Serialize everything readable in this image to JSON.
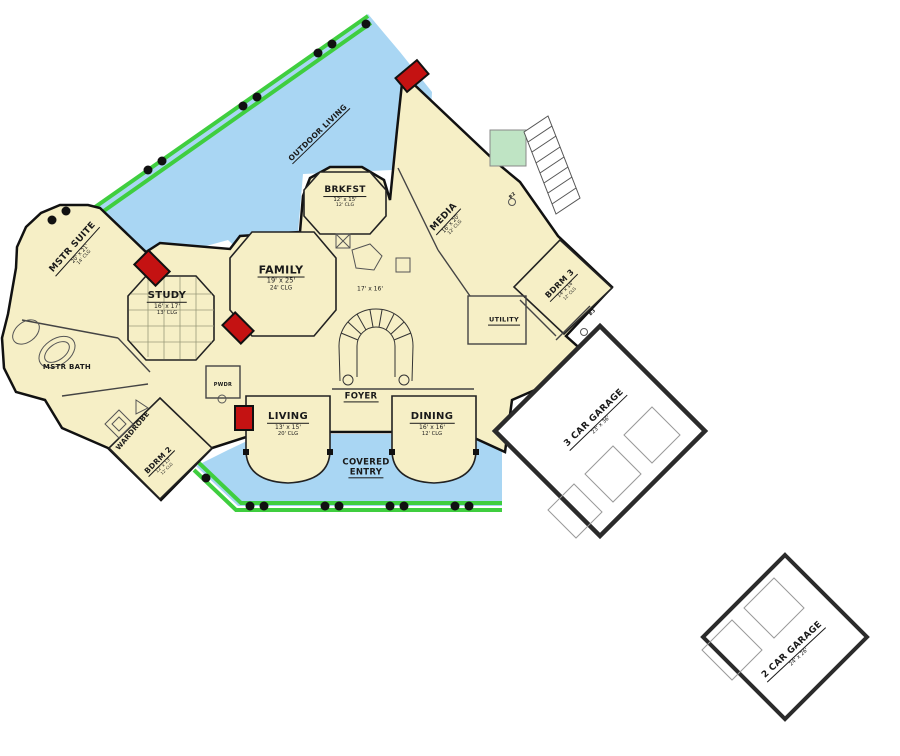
{
  "plan": {
    "type": "floor-plan",
    "colors": {
      "floor": "#F6EFC6",
      "outdoor": "#A9D6F3",
      "rail": "#3FCE3F",
      "landing": "#BFE4C4",
      "accent_red": "#C41212",
      "wall": "#111111",
      "garage_wall": "#2B2B2B",
      "text": "#1A1A1A"
    },
    "rooms": {
      "outdoor_living": {
        "name": "OUTDOOR LIVING"
      },
      "mstr_suite": {
        "name": "MSTR SUITE",
        "dims": "20' x 21'",
        "clg": "14' CLG"
      },
      "study": {
        "name": "STUDY",
        "dims": "16' x 17'",
        "clg": "13' CLG"
      },
      "family": {
        "name": "FAMILY",
        "dims": "19' x 25'",
        "clg": "24' CLG"
      },
      "brkfst": {
        "name": "BRKFST",
        "dims": "12' x 15'",
        "clg": "12' CLG"
      },
      "kitchen": {
        "dims": "17' x 16'"
      },
      "media": {
        "name": "MEDIA",
        "dims": "16' x 20'",
        "clg": "12' CLG"
      },
      "bdrm3": {
        "name": "BDRM 3",
        "dims": "14' x 14'",
        "clg": "12' CLG"
      },
      "mstr_bath": {
        "name": "MSTR BATH"
      },
      "wardrobe": {
        "name": "WARDROBE"
      },
      "bdrm2": {
        "name": "BDRM 2",
        "dims": "12' x 13'",
        "clg": "12' CLG"
      },
      "pwdr": {
        "name": "PWDR"
      },
      "living": {
        "name": "LIVING",
        "dims": "13' x 15'",
        "clg": "20' CLG"
      },
      "foyer": {
        "name": "FOYER"
      },
      "dining": {
        "name": "DINING",
        "dims": "16' x 16'",
        "clg": "12' CLG"
      },
      "covered_entry": {
        "line1": "COVERED",
        "line2": "ENTRY"
      },
      "utility": {
        "name": "UTILITY"
      },
      "garage3": {
        "name": "3 CAR GARAGE",
        "dims": "23' x 36'"
      },
      "garage2": {
        "name": "2 CAR GARAGE",
        "dims": "24' x 26'"
      }
    },
    "baths": {
      "b2": "B2",
      "b3": "B3"
    }
  }
}
